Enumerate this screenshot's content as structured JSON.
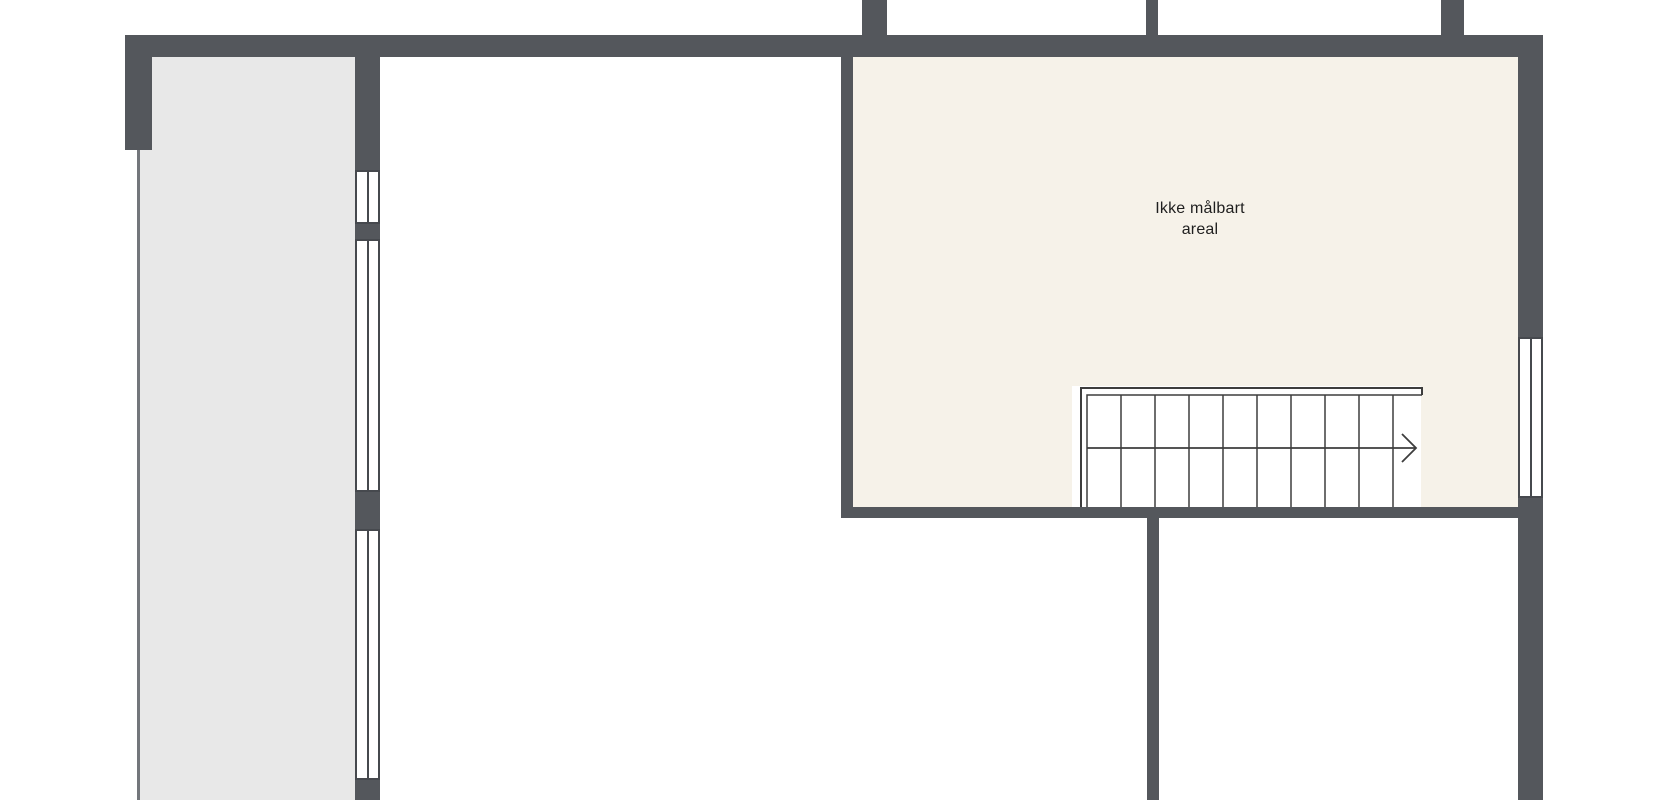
{
  "floorplan": {
    "type": "floor-plan",
    "room_label": "Ikke målbart areal",
    "stair_direction": "right",
    "stair_steps": 10
  },
  "colors": {
    "background": "#ffffff",
    "wall": "#54575c",
    "room_gray": "#e8e8e8",
    "room_beige": "#f6f2e9",
    "outline": "#73767b",
    "frame": "#46494e",
    "stair_line": "#3d3d3d",
    "text": "#1f1f1f"
  }
}
